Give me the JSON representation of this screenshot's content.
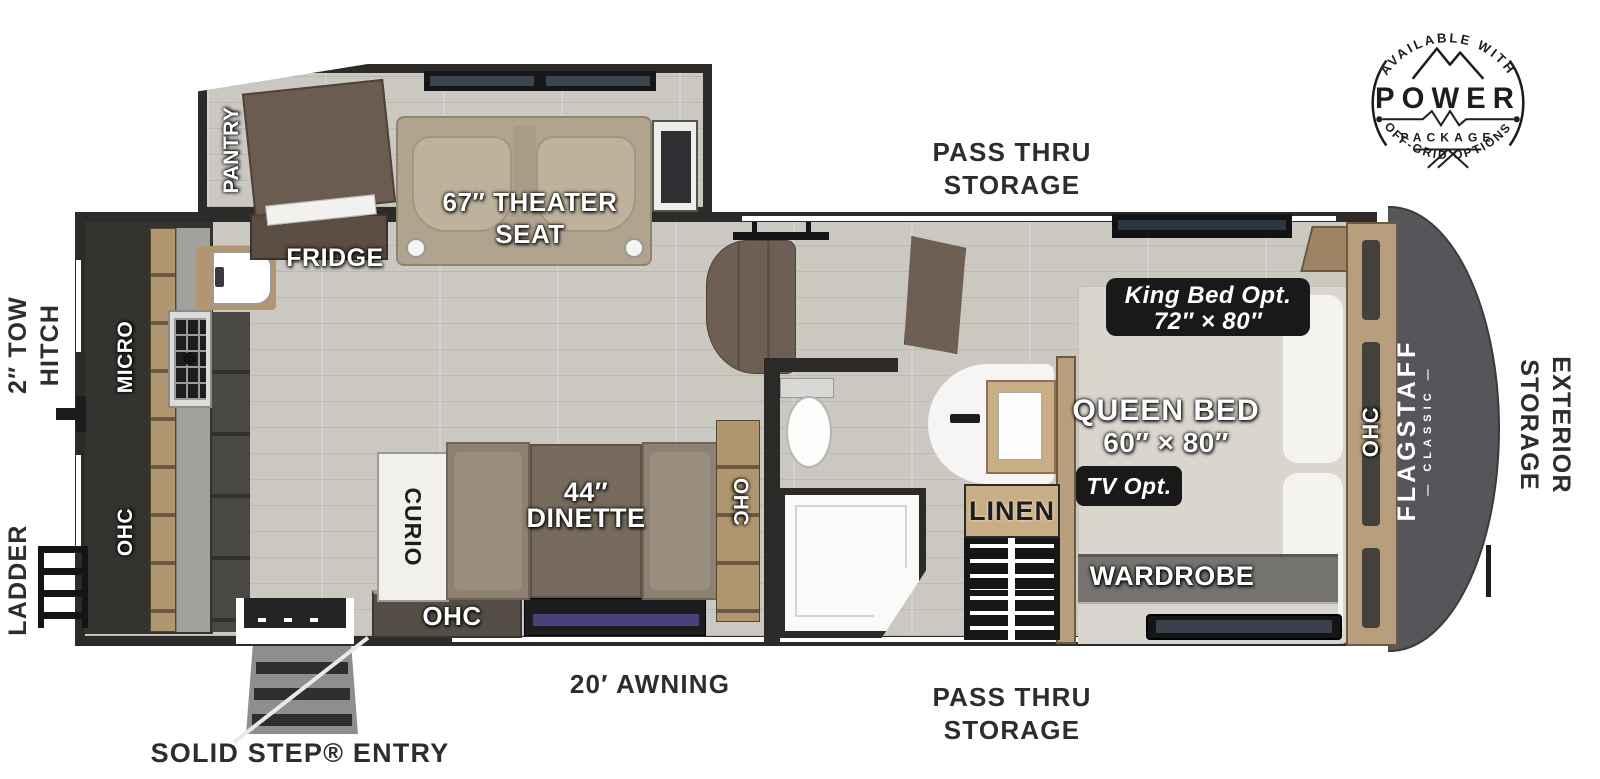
{
  "title": "Flagstaff Classic fifth wheel floor plan",
  "badge": {
    "top_arc": "AVAILABLE WITH",
    "title": "POWER",
    "subtitle": "PACKAGE",
    "bottom_arc": "OFF-GRID OPTIONS"
  },
  "exterior_labels": {
    "pass_thru_top_line1": "PASS THRU",
    "pass_thru_top_line2": "STORAGE",
    "tow_hitch_line1": "2″ TOW",
    "tow_hitch_line2": "HITCH",
    "ladder": "LADDER",
    "exterior_storage_line1": "EXTERIOR",
    "exterior_storage_line2": "STORAGE",
    "awning": "20′ AWNING",
    "pass_thru_bottom_line1": "PASS THRU",
    "pass_thru_bottom_line2": "STORAGE",
    "solid_step": "SOLID STEP® ENTRY"
  },
  "labels": {
    "pantry": "PANTRY",
    "fridge": "FRIDGE",
    "theater_line1": "67″ THEATER",
    "theater_line2": "SEAT",
    "micro": "MICRO",
    "ohc": "OHC",
    "curio": "CURIO",
    "dinette_line1": "44″",
    "dinette_line2": "DINETTE",
    "tv": "TV",
    "linen": "LINEN",
    "king_line1": "King Bed Opt.",
    "king_line2": "72″ × 80″",
    "queen_line1": "QUEEN BED",
    "queen_line2": "60″ × 80″",
    "tv_opt": "TV Opt.",
    "wardrobe": "WARDROBE",
    "flagstaff": "FLAGSTAFF",
    "classic": "— CLASSIC —"
  },
  "colors": {
    "wall": "#2c2b29",
    "floor": "#cbc7c1",
    "cap": "#55565a",
    "wood": "#b1976f",
    "wood-dark": "#6b5a41",
    "front-wood": "#b79e7d",
    "furniture-brown": "#6e5f55",
    "seat-tan": "#b0a48f",
    "bench": "#8d8173",
    "table": "#776b5e",
    "bed": "#dbd6cd",
    "pillow": "#f4f3f0",
    "badge-black": "#191919",
    "linen-tan": "#c9ad85",
    "tv-screen": "#4a3f78"
  }
}
